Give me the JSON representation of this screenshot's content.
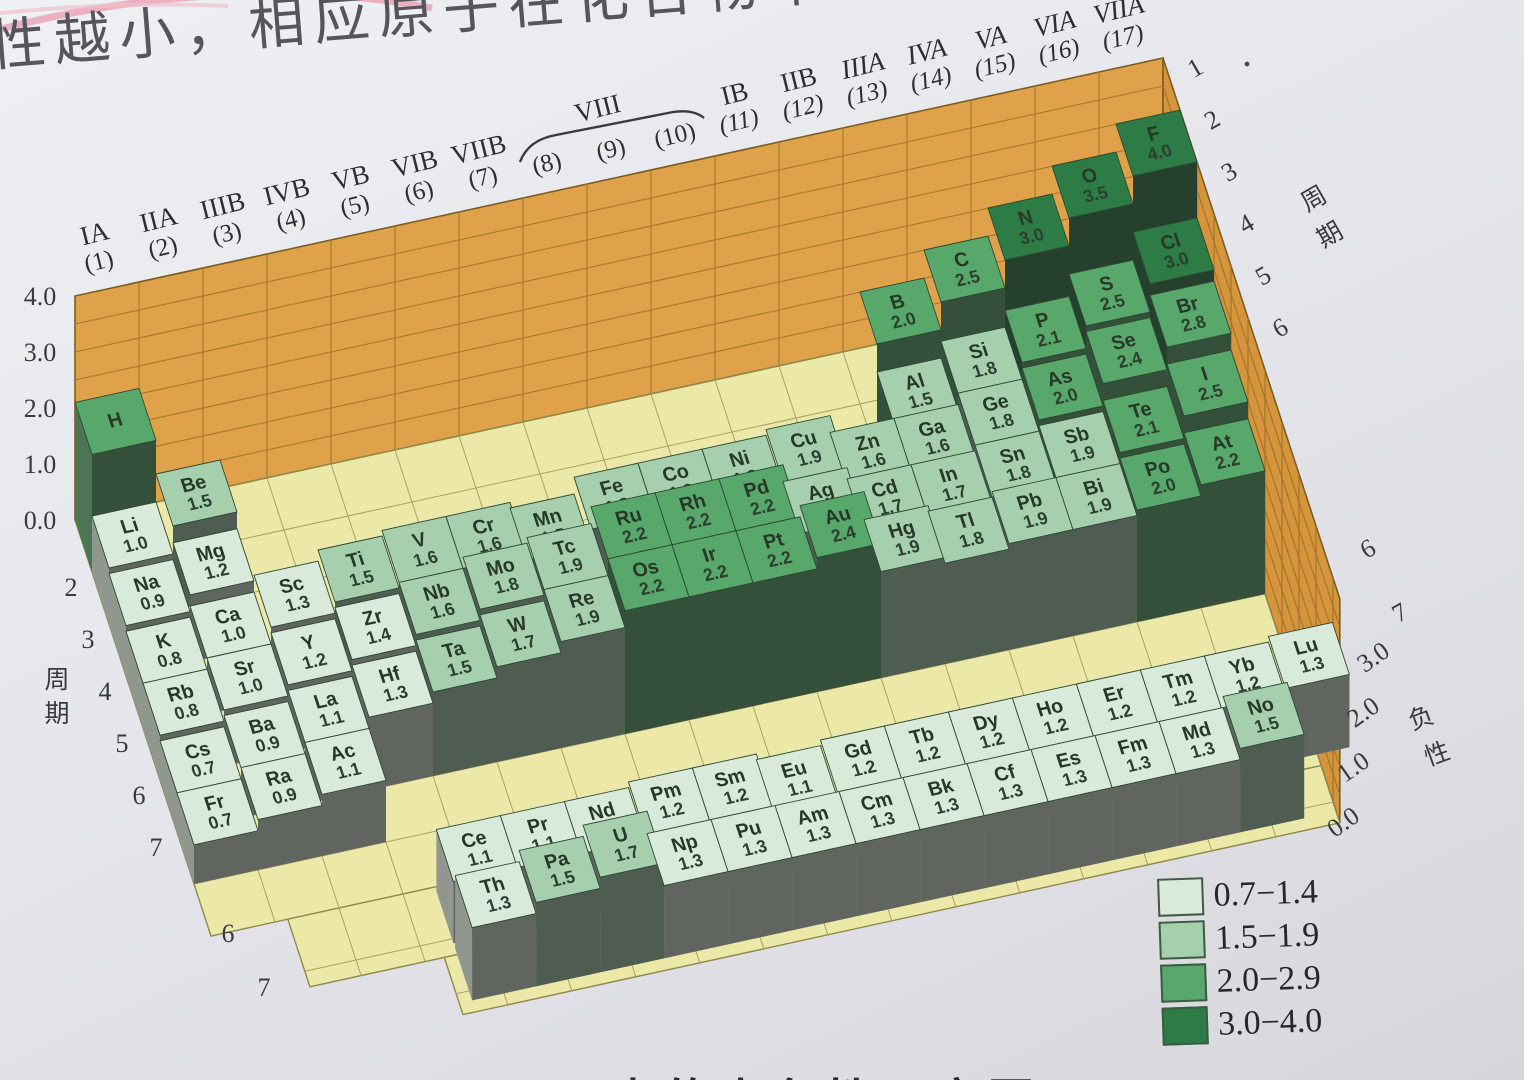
{
  "page": {
    "heading_fragment": "性越小，相应原子在化合物中",
    "bottom_caption_fragment": "元素的电负性示意图"
  },
  "chart_data": {
    "type": "bar",
    "height_axis": {
      "ticks_left": [
        "4.0",
        "3.0",
        "2.0",
        "1.0",
        "0.0"
      ],
      "ticks_right": [
        "3.0",
        "2.0",
        "1.0",
        "0.0"
      ],
      "right_label": "负性"
    },
    "period_axis": {
      "label": "周期",
      "left_ticks": [
        "2",
        "3",
        "4",
        "5",
        "6",
        "7"
      ],
      "left_front_ticks": [
        "6",
        "7"
      ],
      "right_ticks": [
        "1",
        "2",
        "3",
        "4",
        "5",
        "6"
      ],
      "right_front_ticks": [
        "6",
        "7"
      ]
    },
    "group_labels": [
      {
        "roman": "IA",
        "num": "(1)"
      },
      {
        "roman": "IIA",
        "num": "(2)"
      },
      {
        "roman": "IIIB",
        "num": "(3)"
      },
      {
        "roman": "IVB",
        "num": "(4)"
      },
      {
        "roman": "VB",
        "num": "(5)"
      },
      {
        "roman": "VIB",
        "num": "(6)"
      },
      {
        "roman": "VIIB",
        "num": "(7)"
      },
      {
        "roman": "",
        "num": "(8)"
      },
      {
        "roman": "VIII",
        "num": "(9)"
      },
      {
        "roman": "",
        "num": "(10)"
      },
      {
        "roman": "IB",
        "num": "(11)"
      },
      {
        "roman": "IIB",
        "num": "(12)"
      },
      {
        "roman": "IIIA",
        "num": "(13)"
      },
      {
        "roman": "IVA",
        "num": "(14)"
      },
      {
        "roman": "VA",
        "num": "(15)"
      },
      {
        "roman": "VIA",
        "num": "(16)"
      },
      {
        "roman": "VIIA",
        "num": "(17)"
      }
    ],
    "legend": [
      {
        "range": "0.7−1.4",
        "color": "#d9e9da"
      },
      {
        "range": "1.5−1.9",
        "color": "#a6cfae"
      },
      {
        "range": "2.0−2.9",
        "color": "#58a76b"
      },
      {
        "range": "3.0−4.0",
        "color": "#2d7c45"
      }
    ],
    "elements": [
      {
        "symbol": "H",
        "value": "2.1",
        "period": 1,
        "group": 1,
        "show_value": false
      },
      {
        "symbol": "Li",
        "value": "1.0",
        "period": 2,
        "group": 1
      },
      {
        "symbol": "Be",
        "value": "1.5",
        "period": 2,
        "group": 2
      },
      {
        "symbol": "B",
        "value": "2.0",
        "period": 2,
        "group": 13
      },
      {
        "symbol": "C",
        "value": "2.5",
        "period": 2,
        "group": 14
      },
      {
        "symbol": "N",
        "value": "3.0",
        "period": 2,
        "group": 15
      },
      {
        "symbol": "O",
        "value": "3.5",
        "period": 2,
        "group": 16
      },
      {
        "symbol": "F",
        "value": "4.0",
        "period": 2,
        "group": 17
      },
      {
        "symbol": "Na",
        "value": "0.9",
        "period": 3,
        "group": 1
      },
      {
        "symbol": "Mg",
        "value": "1.2",
        "period": 3,
        "group": 2
      },
      {
        "symbol": "Al",
        "value": "1.5",
        "period": 3,
        "group": 13
      },
      {
        "symbol": "Si",
        "value": "1.8",
        "period": 3,
        "group": 14
      },
      {
        "symbol": "P",
        "value": "2.1",
        "period": 3,
        "group": 15
      },
      {
        "symbol": "S",
        "value": "2.5",
        "period": 3,
        "group": 16
      },
      {
        "symbol": "Cl",
        "value": "3.0",
        "period": 3,
        "group": 17
      },
      {
        "symbol": "K",
        "value": "0.8",
        "period": 4,
        "group": 1
      },
      {
        "symbol": "Ca",
        "value": "1.0",
        "period": 4,
        "group": 2
      },
      {
        "symbol": "Sc",
        "value": "1.3",
        "period": 4,
        "group": 3
      },
      {
        "symbol": "Ti",
        "value": "1.5",
        "period": 4,
        "group": 4
      },
      {
        "symbol": "V",
        "value": "1.6",
        "period": 4,
        "group": 5
      },
      {
        "symbol": "Cr",
        "value": "1.6",
        "period": 4,
        "group": 6
      },
      {
        "symbol": "Mn",
        "value": "1.5",
        "period": 4,
        "group": 7
      },
      {
        "symbol": "Fe",
        "value": "1.8",
        "period": 4,
        "group": 8
      },
      {
        "symbol": "Co",
        "value": "1.8",
        "period": 4,
        "group": 9
      },
      {
        "symbol": "Ni",
        "value": "1.8",
        "period": 4,
        "group": 10
      },
      {
        "symbol": "Cu",
        "value": "1.9",
        "period": 4,
        "group": 11
      },
      {
        "symbol": "Zn",
        "value": "1.6",
        "period": 4,
        "group": 12
      },
      {
        "symbol": "Ga",
        "value": "1.6",
        "period": 4,
        "group": 13
      },
      {
        "symbol": "Ge",
        "value": "1.8",
        "period": 4,
        "group": 14
      },
      {
        "symbol": "As",
        "value": "2.0",
        "period": 4,
        "group": 15
      },
      {
        "symbol": "Se",
        "value": "2.4",
        "period": 4,
        "group": 16
      },
      {
        "symbol": "Br",
        "value": "2.8",
        "period": 4,
        "group": 17
      },
      {
        "symbol": "Rb",
        "value": "0.8",
        "period": 5,
        "group": 1
      },
      {
        "symbol": "Sr",
        "value": "1.0",
        "period": 5,
        "group": 2
      },
      {
        "symbol": "Y",
        "value": "1.2",
        "period": 5,
        "group": 3
      },
      {
        "symbol": "Zr",
        "value": "1.4",
        "period": 5,
        "group": 4
      },
      {
        "symbol": "Nb",
        "value": "1.6",
        "period": 5,
        "group": 5
      },
      {
        "symbol": "Mo",
        "value": "1.8",
        "period": 5,
        "group": 6
      },
      {
        "symbol": "Tc",
        "value": "1.9",
        "period": 5,
        "group": 7
      },
      {
        "symbol": "Ru",
        "value": "2.2",
        "period": 5,
        "group": 8
      },
      {
        "symbol": "Rh",
        "value": "2.2",
        "period": 5,
        "group": 9
      },
      {
        "symbol": "Pd",
        "value": "2.2",
        "period": 5,
        "group": 10
      },
      {
        "symbol": "Ag",
        "value": "1.9",
        "period": 5,
        "group": 11
      },
      {
        "symbol": "Cd",
        "value": "1.7",
        "period": 5,
        "group": 12
      },
      {
        "symbol": "In",
        "value": "1.7",
        "period": 5,
        "group": 13
      },
      {
        "symbol": "Sn",
        "value": "1.8",
        "period": 5,
        "group": 14
      },
      {
        "symbol": "Sb",
        "value": "1.9",
        "period": 5,
        "group": 15
      },
      {
        "symbol": "Te",
        "value": "2.1",
        "period": 5,
        "group": 16
      },
      {
        "symbol": "I",
        "value": "2.5",
        "period": 5,
        "group": 17
      },
      {
        "symbol": "Cs",
        "value": "0.7",
        "period": 6,
        "group": 1
      },
      {
        "symbol": "Ba",
        "value": "0.9",
        "period": 6,
        "group": 2
      },
      {
        "symbol": "La",
        "value": "1.1",
        "period": 6,
        "group": 3
      },
      {
        "symbol": "Hf",
        "value": "1.3",
        "period": 6,
        "group": 4
      },
      {
        "symbol": "Ta",
        "value": "1.5",
        "period": 6,
        "group": 5
      },
      {
        "symbol": "W",
        "value": "1.7",
        "period": 6,
        "group": 6
      },
      {
        "symbol": "Re",
        "value": "1.9",
        "period": 6,
        "group": 7
      },
      {
        "symbol": "Os",
        "value": "2.2",
        "period": 6,
        "group": 8
      },
      {
        "symbol": "Ir",
        "value": "2.2",
        "period": 6,
        "group": 9
      },
      {
        "symbol": "Pt",
        "value": "2.2",
        "period": 6,
        "group": 10
      },
      {
        "symbol": "Au",
        "value": "2.4",
        "period": 6,
        "group": 11
      },
      {
        "symbol": "Hg",
        "value": "1.9",
        "period": 6,
        "group": 12
      },
      {
        "symbol": "Tl",
        "value": "1.8",
        "period": 6,
        "group": 13
      },
      {
        "symbol": "Pb",
        "value": "1.9",
        "period": 6,
        "group": 14
      },
      {
        "symbol": "Bi",
        "value": "1.9",
        "period": 6,
        "group": 15
      },
      {
        "symbol": "Po",
        "value": "2.0",
        "period": 6,
        "group": 16
      },
      {
        "symbol": "At",
        "value": "2.2",
        "period": 6,
        "group": 17
      },
      {
        "symbol": "Fr",
        "value": "0.7",
        "period": 7,
        "group": 1
      },
      {
        "symbol": "Ra",
        "value": "0.9",
        "period": 7,
        "group": 2
      },
      {
        "symbol": "Ac",
        "value": "1.1",
        "period": 7,
        "group": 3
      }
    ],
    "lanthanides": [
      {
        "symbol": "Ce",
        "value": "1.1"
      },
      {
        "symbol": "Pr",
        "value": "1.1"
      },
      {
        "symbol": "Nd",
        "value": "1.1"
      },
      {
        "symbol": "Pm",
        "value": "1.2"
      },
      {
        "symbol": "Sm",
        "value": "1.2"
      },
      {
        "symbol": "Eu",
        "value": "1.1"
      },
      {
        "symbol": "Gd",
        "value": "1.2"
      },
      {
        "symbol": "Tb",
        "value": "1.2"
      },
      {
        "symbol": "Dy",
        "value": "1.2"
      },
      {
        "symbol": "Ho",
        "value": "1.2"
      },
      {
        "symbol": "Er",
        "value": "1.2"
      },
      {
        "symbol": "Tm",
        "value": "1.2"
      },
      {
        "symbol": "Yb",
        "value": "1.2"
      },
      {
        "symbol": "Lu",
        "value": "1.3"
      }
    ],
    "actinides": [
      {
        "symbol": "Th",
        "value": "1.3"
      },
      {
        "symbol": "Pa",
        "value": "1.5"
      },
      {
        "symbol": "U",
        "value": "1.7"
      },
      {
        "symbol": "Np",
        "value": "1.3"
      },
      {
        "symbol": "Pu",
        "value": "1.3"
      },
      {
        "symbol": "Am",
        "value": "1.3"
      },
      {
        "symbol": "Cm",
        "value": "1.3"
      },
      {
        "symbol": "Bk",
        "value": "1.3"
      },
      {
        "symbol": "Cf",
        "value": "1.3"
      },
      {
        "symbol": "Es",
        "value": "1.3"
      },
      {
        "symbol": "Fm",
        "value": "1.3"
      },
      {
        "symbol": "Md",
        "value": "1.3"
      },
      {
        "symbol": "No",
        "value": "1.5"
      }
    ]
  }
}
